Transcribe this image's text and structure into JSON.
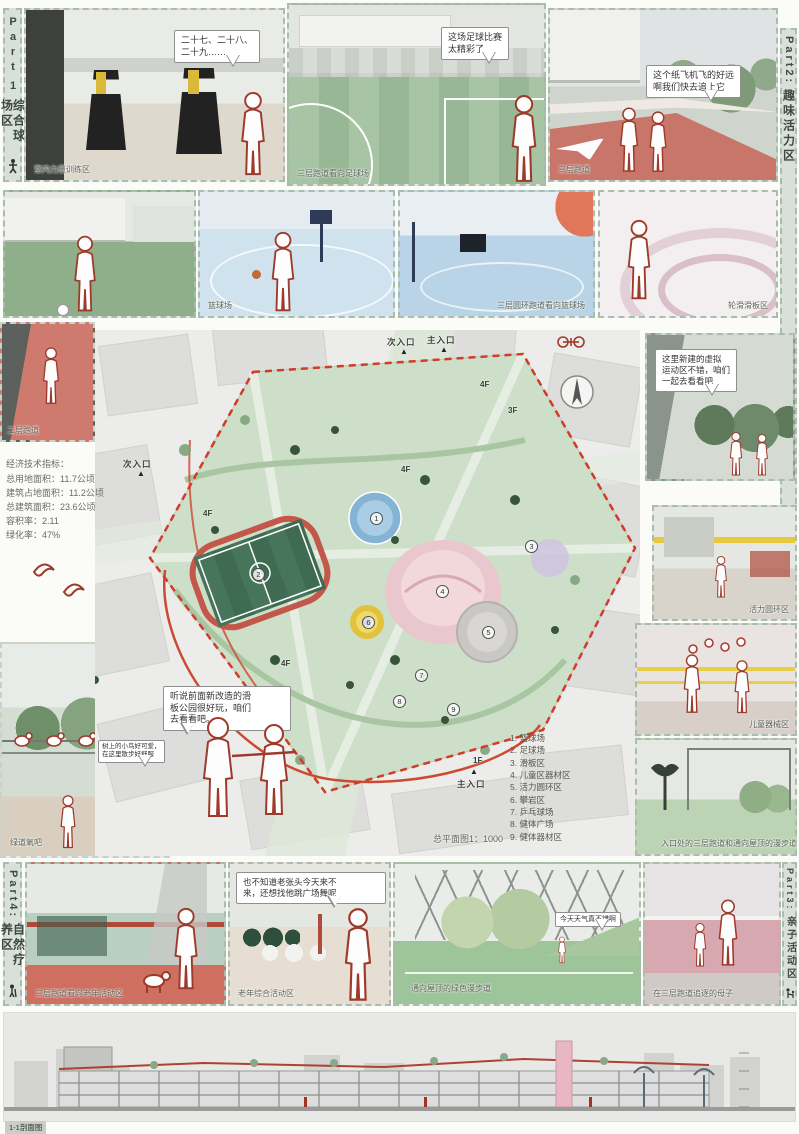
{
  "colors": {
    "outline_red": "#9e3a2b",
    "boundary_red": "#d23b2a",
    "pitch_green": "#3f6b52",
    "plan_green": "#cddfc8",
    "pool_blue": "#85b3d4",
    "play_pink": "#eac6ce",
    "ring_yellow": "#e2c23c",
    "strip_bg": "#d9e0d9"
  },
  "part_labels": {
    "part1": {
      "en": "Part",
      "num": "1",
      "zh": "综合球场区"
    },
    "part2": {
      "en": "Part2:",
      "zh": "趣味活力区"
    },
    "part3": {
      "en": "Part3:",
      "zh": "亲子活动区"
    },
    "part4": {
      "en": "Part4:",
      "zh": "自然疗养区"
    }
  },
  "row1": {
    "gym": {
      "caption": "室内力量训练区",
      "bubble": "二十七、二十八、\n二十九……"
    },
    "football": {
      "caption": "三层跑道看向足球场",
      "bubble": "这场足球比赛\n太精彩了"
    },
    "ramp": {
      "caption": "三层跑道",
      "bubble": "这个纸飞机飞的好远\n啊我们快去追上它"
    }
  },
  "row2": {
    "basketball_caption": "篮球场",
    "ring_caption": "三层圆环跑道看向篮球场",
    "roller_caption": "轮滑滑板区"
  },
  "left": {
    "runner_caption": "二层跑道",
    "indicators": {
      "title": "经济技术指标：",
      "lines": [
        "总用地面积：11.7公顷",
        "建筑占地面积：11.2公顷",
        "总建筑面积：23.6公顷",
        "容积率：2.11",
        "绿化率：47%"
      ]
    },
    "greenway": {
      "caption": "绿道氧吧",
      "bubble": "树上的小鸟好可爱，\n在这里散步好舒服"
    }
  },
  "plan": {
    "marker": "▲",
    "entrance_top_secondary": "次入口",
    "entrance_top_main": "主入口",
    "entrance_left_secondary": "次入口",
    "entrance_bottom_main": "主入口",
    "floors": {
      "f4": "4F",
      "f3": "3F",
      "f2": "2F",
      "f1": "1F"
    },
    "numbers": [
      "1",
      "2",
      "3",
      "4",
      "5",
      "6",
      "7",
      "8",
      "9"
    ],
    "legend": [
      "1. 篮球场",
      "2. 足球场",
      "3. 滑板区",
      "4. 儿童区器材区",
      "5. 活力圆环区",
      "6. 攀岩区",
      "7. 乒乓球场",
      "8. 健体广场",
      "9. 健体器材区"
    ],
    "caption": "总平面图1：1000",
    "bubble": "听说前面新改造的滑\n板公园很好玩，咱们\n去看看吧。"
  },
  "right": {
    "virtual_bubble": "这里新建的虚拟\n运动区不错，咱们\n一起去看看吧",
    "ring_caption": "活力圆环区",
    "kids_caption": "儿童器械区",
    "entry_caption": "入口处的三层跑道和通向屋顶的漫步道"
  },
  "row4": {
    "elderly_caption": "三层跑道看向老年活动区",
    "plaza": {
      "caption": "老年综合活动区",
      "bubble": "也不知道老张头今天来不\n来，还想找他跳广场舞呢"
    },
    "greenwalk": {
      "caption": "通向屋顶的绿色漫步道",
      "bubble": "今天天气真不错啊"
    },
    "motherchild_caption": "在三层跑道追逐的母子"
  },
  "section": {
    "caption": "1-1剖面图"
  }
}
